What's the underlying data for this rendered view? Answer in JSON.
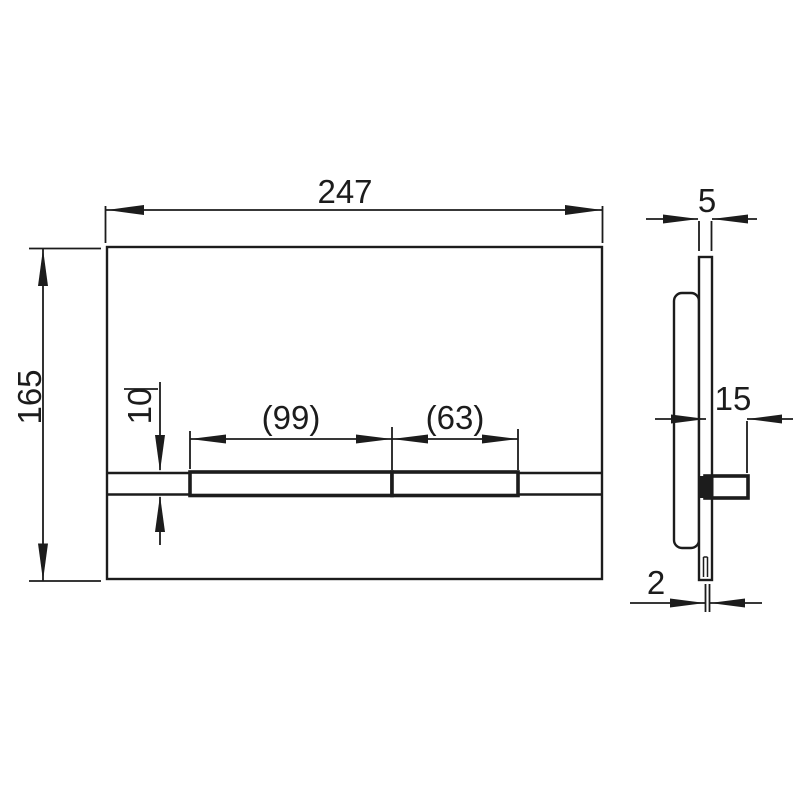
{
  "drawing": {
    "type": "technical-drawing",
    "colors": {
      "line": "#1c1c1c",
      "background": "#ffffff"
    },
    "front_view": {
      "width_label": "247",
      "height_label": "165",
      "strip_height_label": "10",
      "large_button_label": "(99)",
      "small_button_label": "(63)"
    },
    "side_view": {
      "plate_thickness_label": "5",
      "button_projection_label": "15",
      "edge_thickness_label": "2"
    }
  }
}
